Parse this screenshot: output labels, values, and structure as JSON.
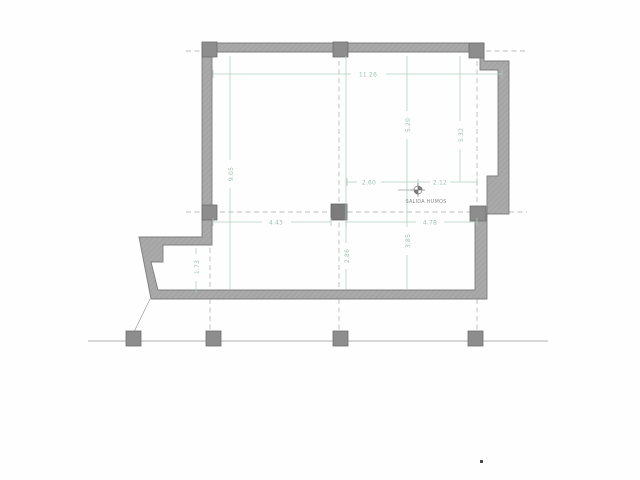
{
  "plan": {
    "annotations": {
      "smoke_outlet": "SALIDA HUMOS"
    },
    "dimensions": {
      "overall_width": "11.26",
      "upper_right_height": "5.20",
      "right_edge_height": "5.32",
      "left_height": "9.05",
      "smoke_outlet_left": "2.60",
      "smoke_outlet_right": "2.12",
      "lower_left_width": "4.43",
      "lower_right_width": "4.78",
      "lower_right_height": "3.85",
      "lower_center_height": "2.86",
      "lower_left_height": "1.73"
    },
    "colors": {
      "wall_gray": "#a9a9a9",
      "column_gray": "#8d8d8d",
      "dimension_green": "#b3d1c2",
      "dimension_text_green": "#9cc2ae",
      "axis_dash_gray": "#bcbcbc",
      "annotation_gray": "#8a8a8a",
      "background": "#fefefe"
    }
  }
}
